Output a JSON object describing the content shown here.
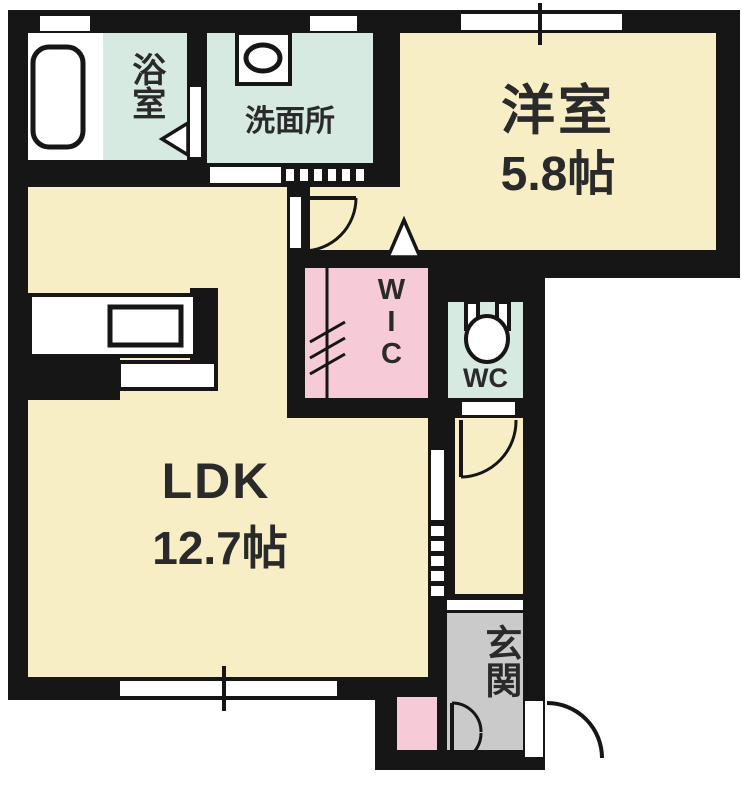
{
  "floorplan": {
    "type": "apartment-floor-plan",
    "rooms": {
      "bathroom": {
        "label": "浴室"
      },
      "washroom": {
        "label": "洗面所"
      },
      "western_room": {
        "label": "洋室",
        "area": "5.8帖"
      },
      "ldk": {
        "label": "LDK",
        "area": "12.7帖"
      },
      "wic": {
        "label": "WIC"
      },
      "wc": {
        "label": "WC"
      },
      "entrance": {
        "label": "玄関"
      }
    },
    "icons": [
      "bathtub-icon",
      "washing-machine-icon",
      "kitchen-counter-icon",
      "toilet-icon",
      "door-swing-arc",
      "folding-door-icon",
      "sliding-door-icon",
      "window-icon",
      "entry-triangle-icon"
    ],
    "colors": {
      "floor_yellow": "#F8EEC6",
      "sanitary_mint": "#D6EAE1",
      "closet_pink": "#F6CAD6",
      "entrance_gray": "#CACACA",
      "wall_black": "#161616",
      "label_text": "#2a2a2a"
    }
  }
}
